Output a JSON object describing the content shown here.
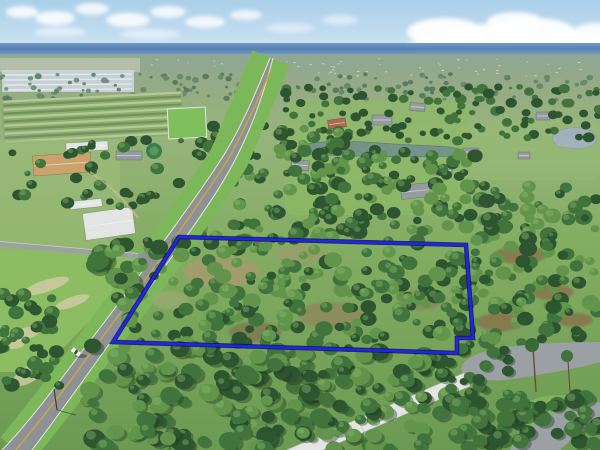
{
  "meta": {
    "type": "aerial-drone-photograph",
    "subject": "vacant wooded land parcel outlined in blue beside a rural highway"
  },
  "scene": {
    "sky": {
      "top": "#aacfe9",
      "mid": "#c2dcf0",
      "low": "#dcebf6",
      "cloud": "#ffffff",
      "horizon_top": "#6f97c2",
      "horizon_main": "#4d7bb0"
    },
    "terrain": {
      "haze": "#8fa698",
      "distant_field": "#b9c3ac",
      "greenhouse": "#ccd5db",
      "field_mid": "#97b47c",
      "field_bright": "#7fc05c",
      "lawn": "#8cbc63",
      "grass_dry": "#d3cba6",
      "dirt": "#8a6f4e",
      "pavement": "#8e9296",
      "pavement_light": "#9aa0a3",
      "roof_white": "#e2e5e3",
      "roof_tan": "#c9a36b",
      "roof_gray": "#959ba1",
      "roof_red": "#b06a52",
      "water_lake": "#74948a",
      "water_pond": "#a3b2ba",
      "road_center_line": "#d2a93c",
      "road_edge_line": "#eeece2"
    },
    "trees": {
      "dark": "#2d5530",
      "mid": "#41743c",
      "light": "#62954b",
      "pale": "#8fbb6d",
      "distant": "#5f8168",
      "distant_dark": "#4e6f58",
      "shadow": "#1e3a1e"
    },
    "boundary": {
      "color": "#2127e0",
      "outline": "#0d1170",
      "points": [
        [
          179,
          237
        ],
        [
          466,
          245
        ],
        [
          473,
          338
        ],
        [
          457,
          338
        ],
        [
          457,
          353
        ],
        [
          113,
          342
        ]
      ]
    },
    "distant_speckles": {
      "seed": 7,
      "n": 70,
      "x": 0,
      "y": 58,
      "w": 600,
      "h": 18,
      "fill": "#e9edf0"
    },
    "nursery": {
      "x": 2,
      "y": 96,
      "w": 182,
      "h": 44,
      "rows": 11,
      "rot": -3,
      "c1": "#6e9458",
      "c2": "#b7c998"
    },
    "tree_bands": [
      {
        "layer": "trees-distant",
        "seed": 11,
        "n": 150,
        "x": 0,
        "y": 74,
        "w": 600,
        "h": 26,
        "rmin": 1.5,
        "rmax": 3.5,
        "colors": [
          "distant",
          "distant_dark"
        ],
        "hl": false,
        "shadow": false
      },
      {
        "layer": "trees-mid",
        "seed": 21,
        "n": 40,
        "x": 0,
        "y": 138,
        "w": 215,
        "h": 75,
        "rmin": 3,
        "rmax": 7,
        "colors": [
          "mid",
          "dark"
        ],
        "hl": true,
        "shadow": false
      },
      {
        "layer": "trees-mid",
        "seed": 22,
        "n": 120,
        "x": 285,
        "y": 86,
        "w": 315,
        "h": 55,
        "rmin": 3,
        "rmax": 6,
        "colors": [
          "mid",
          "dark"
        ],
        "hl": false,
        "shadow": false
      },
      {
        "layer": "trees-mid",
        "seed": 23,
        "n": 85,
        "x": 200,
        "y": 118,
        "w": 145,
        "h": 122,
        "rmin": 4,
        "rmax": 8,
        "colors": [
          "dark",
          "mid",
          "light"
        ],
        "hl": true,
        "shadow": false
      },
      {
        "layer": "trees-mid",
        "seed": 24,
        "n": 110,
        "x": 295,
        "y": 150,
        "w": 180,
        "h": 88,
        "rmin": 4,
        "rmax": 8,
        "colors": [
          "mid",
          "dark",
          "light"
        ],
        "hl": true,
        "shadow": false
      },
      {
        "layer": "trees-oak",
        "seed": 25,
        "n": 6,
        "x": 92,
        "y": 252,
        "w": 40,
        "h": 30,
        "rmin": 8,
        "rmax": 13,
        "colors": [
          "mid",
          "light"
        ],
        "hl": true,
        "shadow": true
      },
      {
        "layer": "trees-parcel",
        "seed": 31,
        "n": 230,
        "x": 112,
        "y": 240,
        "w": 362,
        "h": 110,
        "rmin": 4,
        "rmax": 9,
        "colors": [
          "mid",
          "light",
          "dark"
        ],
        "hl": true,
        "shadow": false
      },
      {
        "layer": "trees-east",
        "seed": 32,
        "n": 120,
        "x": 468,
        "y": 185,
        "w": 132,
        "h": 160,
        "rmin": 4,
        "rmax": 9,
        "colors": [
          "mid",
          "dark",
          "light"
        ],
        "hl": true,
        "shadow": false
      },
      {
        "layer": "trees-west",
        "seed": 33,
        "n": 42,
        "x": 0,
        "y": 292,
        "w": 62,
        "h": 98,
        "rmin": 4,
        "rmax": 8,
        "colors": [
          "dark",
          "mid"
        ],
        "hl": true,
        "shadow": false
      },
      {
        "layer": "trees-foreground",
        "seed": 41,
        "n": 170,
        "x": 85,
        "y": 345,
        "w": 372,
        "h": 105,
        "rmin": 5,
        "rmax": 11,
        "colors": [
          "dark",
          "mid",
          "light"
        ],
        "hl": true,
        "shadow": true
      },
      {
        "layer": "trees-foreground",
        "seed": 42,
        "n": 45,
        "x": 455,
        "y": 393,
        "w": 145,
        "h": 57,
        "rmin": 5,
        "rmax": 10,
        "colors": [
          "dark",
          "mid"
        ],
        "hl": true,
        "shadow": true
      },
      {
        "layer": "trees-foreground",
        "seed": 43,
        "n": 14,
        "x": 448,
        "y": 348,
        "w": 60,
        "h": 42,
        "rmin": 4,
        "rmax": 7,
        "colors": [
          "dark",
          "mid"
        ],
        "hl": false,
        "shadow": true
      }
    ],
    "clearings": [
      {
        "cx": 222,
        "cy": 272,
        "rx": 38,
        "ry": 16,
        "fill": "#a59b6e"
      },
      {
        "cx": 300,
        "cy": 255,
        "rx": 25,
        "ry": 10,
        "fill": "#95a06a"
      },
      {
        "cx": 330,
        "cy": 315,
        "rx": 32,
        "ry": 13,
        "fill": "#8f8a5c"
      },
      {
        "cx": 255,
        "cy": 332,
        "rx": 26,
        "ry": 10,
        "fill": "#7e7c52"
      },
      {
        "cx": 170,
        "cy": 300,
        "rx": 18,
        "ry": 9,
        "fill": "#94ab6d"
      },
      {
        "cx": 420,
        "cy": 300,
        "rx": 22,
        "ry": 10,
        "fill": "#8c8760"
      }
    ],
    "dirt_patches": [
      {
        "cx": 520,
        "cy": 255,
        "rx": 26,
        "ry": 9
      },
      {
        "cx": 552,
        "cy": 292,
        "rx": 22,
        "ry": 8
      },
      {
        "cx": 500,
        "cy": 322,
        "rx": 24,
        "ry": 9
      },
      {
        "cx": 575,
        "cy": 320,
        "rx": 18,
        "ry": 7
      }
    ],
    "sand_patches": [
      {
        "cx": 46,
        "cy": 286,
        "rx": 24,
        "ry": 6,
        "rot": -18
      },
      {
        "cx": 72,
        "cy": 302,
        "rx": 18,
        "ry": 5,
        "rot": -20
      },
      {
        "cx": 24,
        "cy": 334,
        "rx": 16,
        "ry": 6,
        "rot": -15
      },
      {
        "cx": 30,
        "cy": 374,
        "rx": 20,
        "ry": 8,
        "rot": -30
      },
      {
        "cx": 12,
        "cy": 344,
        "rx": 12,
        "ry": 5,
        "rot": 0
      }
    ],
    "buildings": [
      {
        "name": "warehouse",
        "x": 33,
        "y": 154,
        "w": 58,
        "h": 20,
        "rot": -4,
        "roof": "roof_tan"
      },
      {
        "name": "shed-row",
        "x": 66,
        "y": 142,
        "w": 42,
        "h": 9,
        "rot": -3,
        "roof": "roof_white"
      },
      {
        "name": "white-shed",
        "x": 70,
        "y": 200,
        "w": 32,
        "h": 8,
        "rot": -6,
        "roof": "roof_white"
      },
      {
        "name": "pool-enclosure",
        "x": 84,
        "y": 210,
        "w": 50,
        "h": 27,
        "rot": -8,
        "roof": "roof_white"
      },
      {
        "name": "outbuilding",
        "x": 116,
        "y": 151,
        "w": 26,
        "h": 9,
        "rot": 0,
        "roof": "roof_gray"
      },
      {
        "name": "barn-distant",
        "x": 246,
        "y": 96,
        "w": 16,
        "h": 7,
        "rot": 0,
        "roof": "roof_gray"
      },
      {
        "name": "house-red-roof",
        "x": 328,
        "y": 119,
        "w": 18,
        "h": 9,
        "rot": -8,
        "roof": "roof_red"
      },
      {
        "name": "house-1",
        "x": 372,
        "y": 115,
        "w": 20,
        "h": 10,
        "rot": 0,
        "roof": "roof_gray"
      },
      {
        "name": "house-2",
        "x": 410,
        "y": 103,
        "w": 15,
        "h": 8,
        "rot": 4,
        "roof": "roof_gray"
      },
      {
        "name": "house-3",
        "x": 291,
        "y": 160,
        "w": 18,
        "h": 10,
        "rot": 6,
        "roof": "roof_gray"
      },
      {
        "name": "house-with-pool",
        "x": 401,
        "y": 184,
        "w": 29,
        "h": 14,
        "rot": -6,
        "roof": "roof_gray"
      },
      {
        "name": "house-4",
        "x": 434,
        "y": 166,
        "w": 18,
        "h": 9,
        "rot": 0,
        "roof": "roof_gray"
      },
      {
        "name": "house-5",
        "x": 463,
        "y": 148,
        "w": 16,
        "h": 8,
        "rot": 0,
        "roof": "roof_gray"
      },
      {
        "name": "house-6",
        "x": 536,
        "y": 112,
        "w": 14,
        "h": 8,
        "rot": 0,
        "roof": "roof_gray"
      },
      {
        "name": "house-7",
        "x": 518,
        "y": 152,
        "w": 12,
        "h": 7,
        "rot": 0,
        "roof": "roof_gray"
      }
    ]
  }
}
